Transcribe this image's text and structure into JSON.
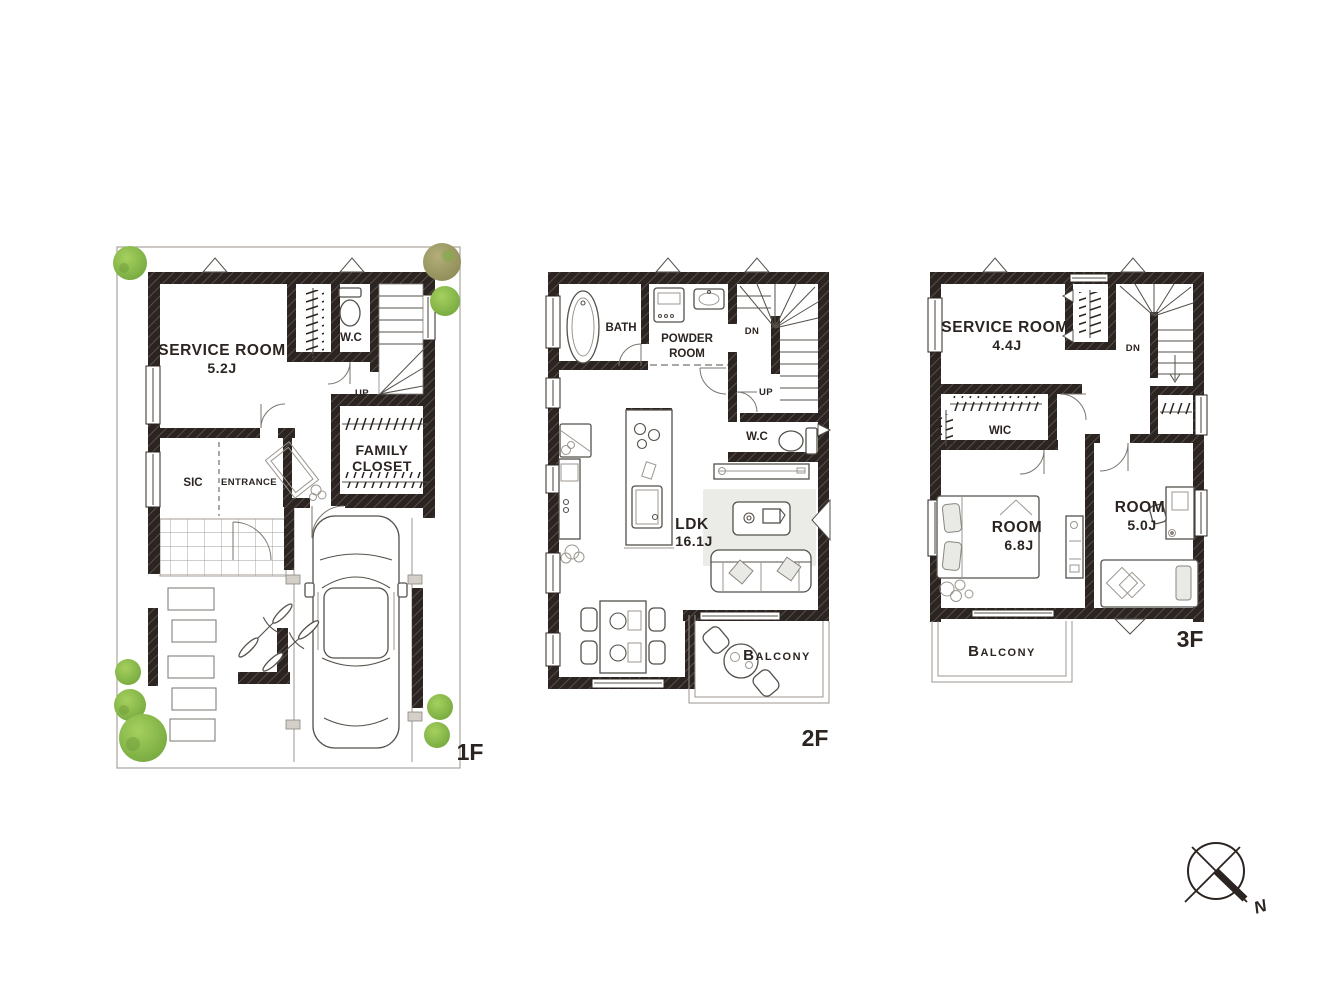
{
  "colors": {
    "wall": "#2b2420",
    "ink": "#2b2420",
    "rug": "#ebebe8",
    "tree_light": "#a5d05e",
    "tree_dark": "#74a73e",
    "olive_light": "#b3ae7a",
    "olive_dark": "#8c8a55"
  },
  "floors": {
    "f1": {
      "floor_label": "1F",
      "service_room": {
        "name": "SERVICE ROOM",
        "size": "5.2J"
      },
      "wc": "W.C",
      "up": "UP",
      "sic": "SIC",
      "entrance": "ENTRANCE",
      "family_closet": {
        "line1": "FAMILY",
        "line2": "CLOSET"
      }
    },
    "f2": {
      "floor_label": "2F",
      "bath": "BATH",
      "powder_room": {
        "line1": "POWDER",
        "line2": "ROOM"
      },
      "dn": "DN",
      "up": "UP",
      "wc": "W.C",
      "ldk": {
        "name": "LDK",
        "size": "16.1J"
      },
      "balcony": "Balcony"
    },
    "f3": {
      "floor_label": "3F",
      "service_room": {
        "name": "SERVICE ROOM",
        "size": "4.4J"
      },
      "dn": "DN",
      "wic": "WIC",
      "room_large": {
        "name": "ROOM",
        "size": "6.8J"
      },
      "room_small": {
        "name": "ROOM",
        "size": "5.0J"
      },
      "balcony": "Balcony"
    }
  },
  "compass": {
    "north_label": "N"
  }
}
